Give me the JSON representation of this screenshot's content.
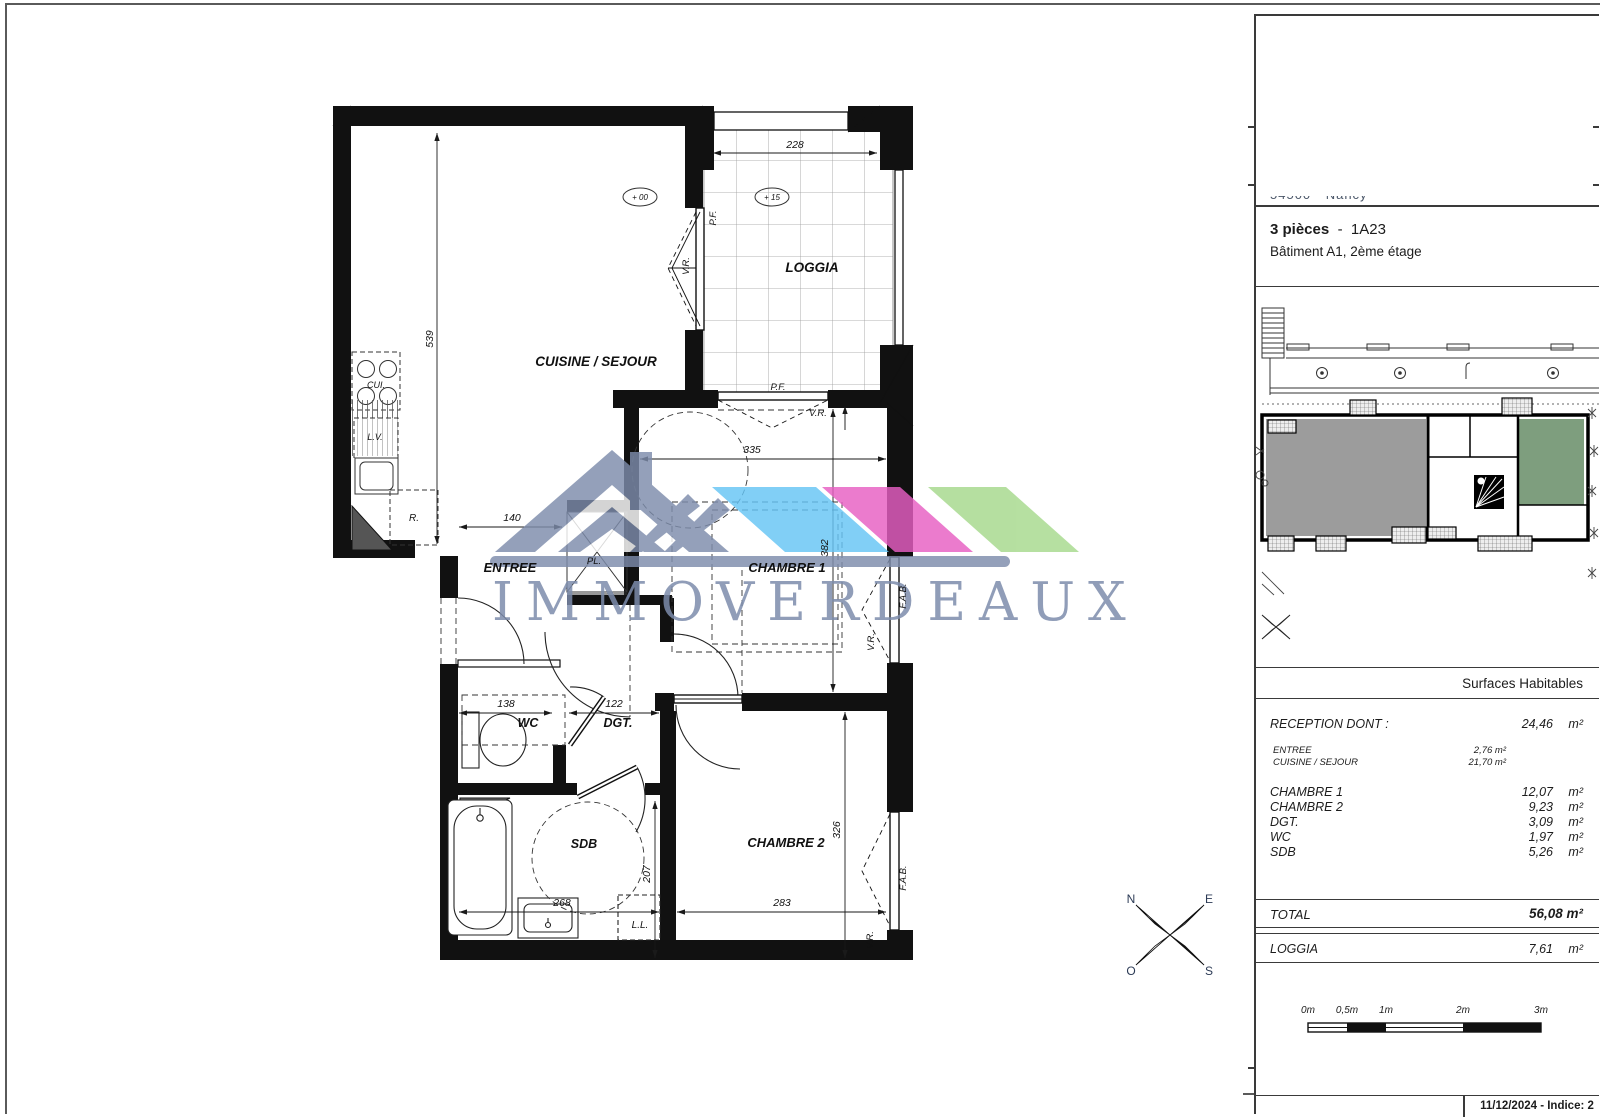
{
  "watermark": {
    "text": "IMMOVERDEAUX"
  },
  "colors": {
    "brand_gray": "#7d8cab",
    "accent_blue": "#66c5f5",
    "accent_pink": "#e75fc3",
    "accent_green": "#a6d98c"
  },
  "plan": {
    "rooms": {
      "cuisine": "CUISINE / SEJOUR",
      "loggia": "LOGGIA",
      "entree": "ENTREE",
      "chambre1": "CHAMBRE 1",
      "chambre2": "CHAMBRE 2",
      "wc": "WC",
      "dgt": "DGT.",
      "sdb": "SDB"
    },
    "dims": {
      "d539": "539",
      "d228": "228",
      "d335": "335",
      "d382": "382",
      "d140": "140",
      "d138": "138",
      "d122": "122",
      "d268": "268",
      "d207": "207",
      "d283": "283",
      "d326": "326"
    },
    "ann": {
      "pf": "P.F.",
      "vr": "V.R.",
      "fab": "F.A.B.",
      "pl": "PL.",
      "r": "R.",
      "cui": "CUI.",
      "lv": "L.V.",
      "ll": "L.L.",
      "lvl0": "+ 00",
      "lvl15": "+ 15"
    },
    "compass": {
      "n": "N",
      "e": "E",
      "o": "O",
      "s": "S"
    }
  },
  "sidebar": {
    "address_clipped": "54500 - Nancy",
    "unit_type": "3 pièces",
    "unit_sep": "-",
    "unit_id": "1A23",
    "unit_location": "Bâtiment A1, 2ème étage",
    "surfaces_title": "Surfaces Habitables",
    "m2": "m²",
    "table": {
      "reception_label": "RECEPTION DONT :",
      "reception_value": "24,46",
      "sub_rows": [
        {
          "label": "ENTREE",
          "value": "2,76 m²"
        },
        {
          "label": "CUISINE / SEJOUR",
          "value": "21,70 m²"
        }
      ],
      "rows": [
        {
          "label": "CHAMBRE 1",
          "value": "12,07"
        },
        {
          "label": "CHAMBRE 2",
          "value": "9,23"
        },
        {
          "label": "DGT.",
          "value": "3,09"
        },
        {
          "label": "WC",
          "value": "1,97"
        },
        {
          "label": "SDB",
          "value": "5,26"
        }
      ],
      "total_label": "TOTAL",
      "total_value": "56,08 m²",
      "loggia_label": "LOGGIA",
      "loggia_value": "7,61"
    },
    "scalebar": {
      "labels": [
        "0m",
        "0,5m",
        "1m",
        "2m",
        "3m"
      ]
    },
    "footer": "11/12/2024 - Indice: 2"
  }
}
